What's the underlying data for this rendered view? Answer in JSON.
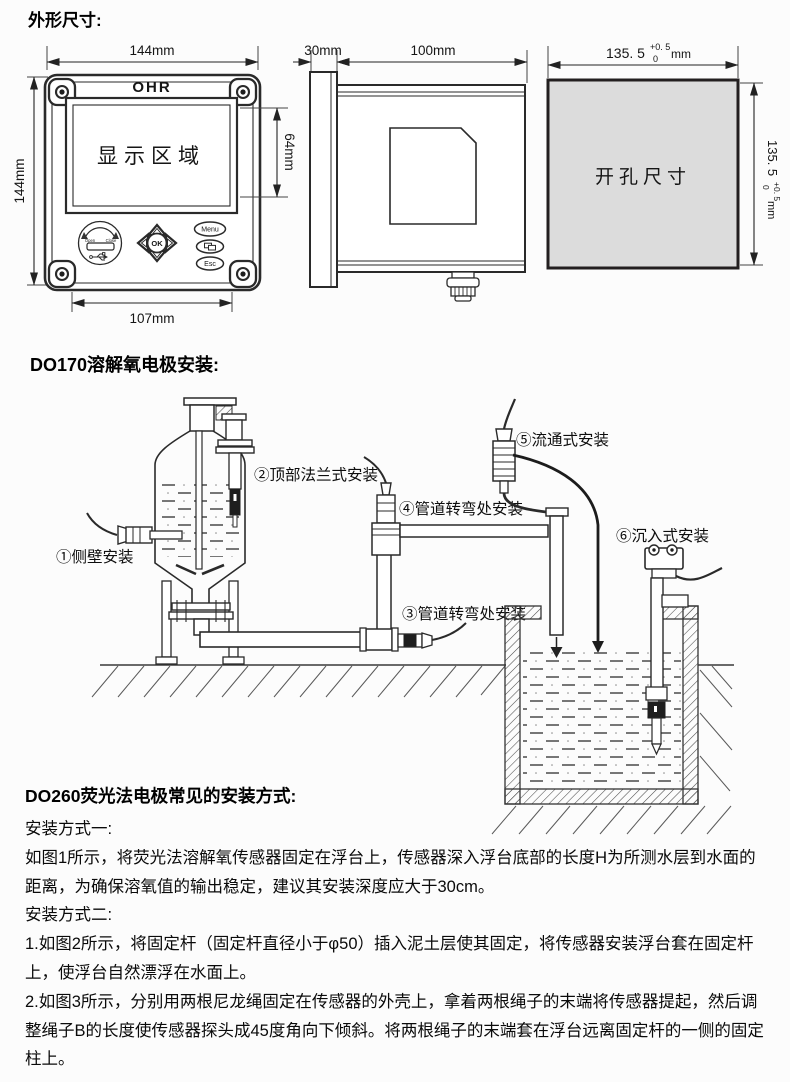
{
  "colors": {
    "page_bg": "#fcfcfc",
    "line": "#2a2a2a",
    "cutout_fill": "#dcdcdc",
    "dark_band": "#1e1e1e"
  },
  "outline": {
    "title": "外形尺寸:",
    "front": {
      "top_width": "144mm",
      "left_height": "144mm",
      "brand": "OHR",
      "display": "显示区域",
      "display_height": "64mm",
      "bottom_width": "107mm",
      "usb_open": "Open",
      "usb_close": "Close",
      "ok": "OK",
      "menu": "Menu",
      "esc": "Esc"
    },
    "side": {
      "bezel": "30mm",
      "depth": "100mm"
    },
    "cutout": {
      "label": "开孔尺寸",
      "w": "135. 5",
      "w_tol_up": "+0. 5",
      "w_tol_dn": "0",
      "w_unit": "mm",
      "h": "135. 5",
      "h_tol_up": "+0. 5",
      "h_tol_dn": "0",
      "h_unit": "mm"
    }
  },
  "do170": {
    "title": "DO170溶解氧电极安装:",
    "labels": {
      "l1": "①侧壁安装",
      "l2": "②顶部法兰式安装",
      "l3": "③管道转弯处安装",
      "l4": "④管道转弯处安装",
      "l5": "⑤流通式安装",
      "l6": "⑥沉入式安装"
    }
  },
  "do260": {
    "title": "DO260荧光法电极常见的安装方式:",
    "method1": "安装方式一:",
    "p1": "如图1所示，将荧光法溶解氧传感器固定在浮台上，传感器深入浮台底部的长度H为所测水层到水面的距离，为确保溶氧值的输出稳定，建议其安装深度应大于30cm。",
    "method2": "安装方式二:",
    "p2": "1.如图2所示，将固定杆（固定杆直径小于φ50）插入泥土层使其固定，将传感器安装浮台套在固定杆上，使浮台自然漂浮在水面上。",
    "p3": "2.如图3所示，分别用两根尼龙绳固定在传感器的外壳上，拿着两根绳子的末端将传感器提起，然后调整绳子B的长度使传感器探头成45度角向下倾斜。将两根绳子的末端套在浮台远离固定杆的一侧的固定柱上。"
  }
}
